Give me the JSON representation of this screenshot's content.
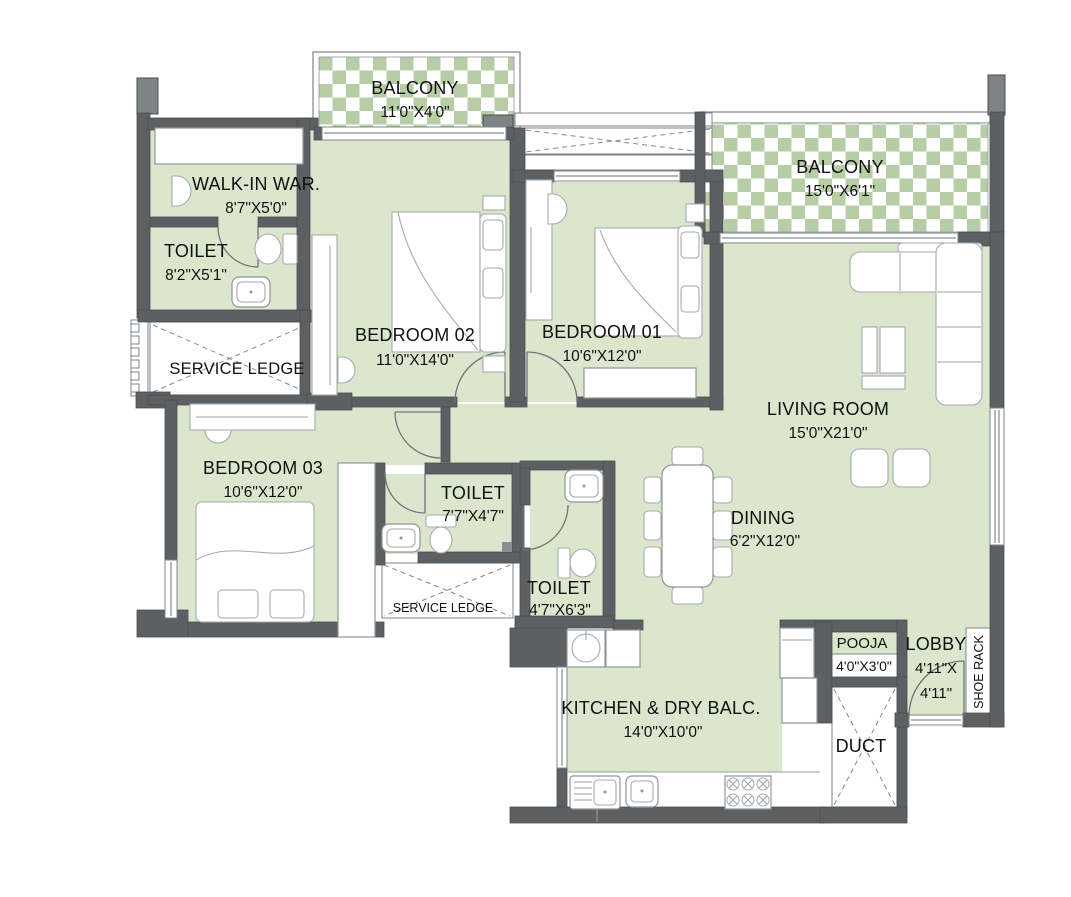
{
  "plan": {
    "type": "residential-floor-plan",
    "colors": {
      "room_fill": "#dbe7cd",
      "checker_green": "#b7cda5",
      "wall": "#5c6063",
      "pier": "#7e8386",
      "furniture_line": "#8f9598",
      "text": "#111111"
    },
    "rooms": {
      "balcony_tl": {
        "label": "BALCONY",
        "dim": "11'0\"X4'0\""
      },
      "walk_in": {
        "label": "WALK-IN WAR.",
        "dim": "8'7\"X5'0\""
      },
      "toilet_tl": {
        "label": "TOILET",
        "dim": "8'2\"X5'1\""
      },
      "service_ledge_left": {
        "label": "SERVICE LEDGE"
      },
      "bedroom_02": {
        "label": "BEDROOM 02",
        "dim": "11'0\"X14'0\""
      },
      "bedroom_01": {
        "label": "BEDROOM 01",
        "dim": "10'6\"X12'0\""
      },
      "balcony_tr": {
        "label": "BALCONY",
        "dim": "15'0\"X6'1\""
      },
      "living": {
        "label": "LIVING ROOM",
        "dim": "15'0\"X21'0\""
      },
      "bedroom_03": {
        "label": "BEDROOM 03",
        "dim": "10'6\"X12'0\""
      },
      "toilet_mid": {
        "label": "TOILET",
        "dim": "7'7\"X4'7\""
      },
      "toilet_bottom": {
        "label": "TOILET",
        "dim": "4'7\"X6'3\""
      },
      "service_ledge_bottom": {
        "label": "SERVICE LEDGE"
      },
      "dining": {
        "label": "DINING",
        "dim": "6'2\"X12'0\""
      },
      "kitchen": {
        "label": "KITCHEN & DRY BALC.",
        "dim": "14'0\"X10'0\""
      },
      "pooja": {
        "label": "POOJA",
        "dim": "4'0\"X3'0\""
      },
      "lobby": {
        "label": "LOBBY",
        "dim_line1": "4'11\"X",
        "dim_line2": "4'11\""
      },
      "shoe_rack": {
        "label": "SHOE RACK"
      },
      "duct": {
        "label": "DUCT"
      }
    }
  }
}
